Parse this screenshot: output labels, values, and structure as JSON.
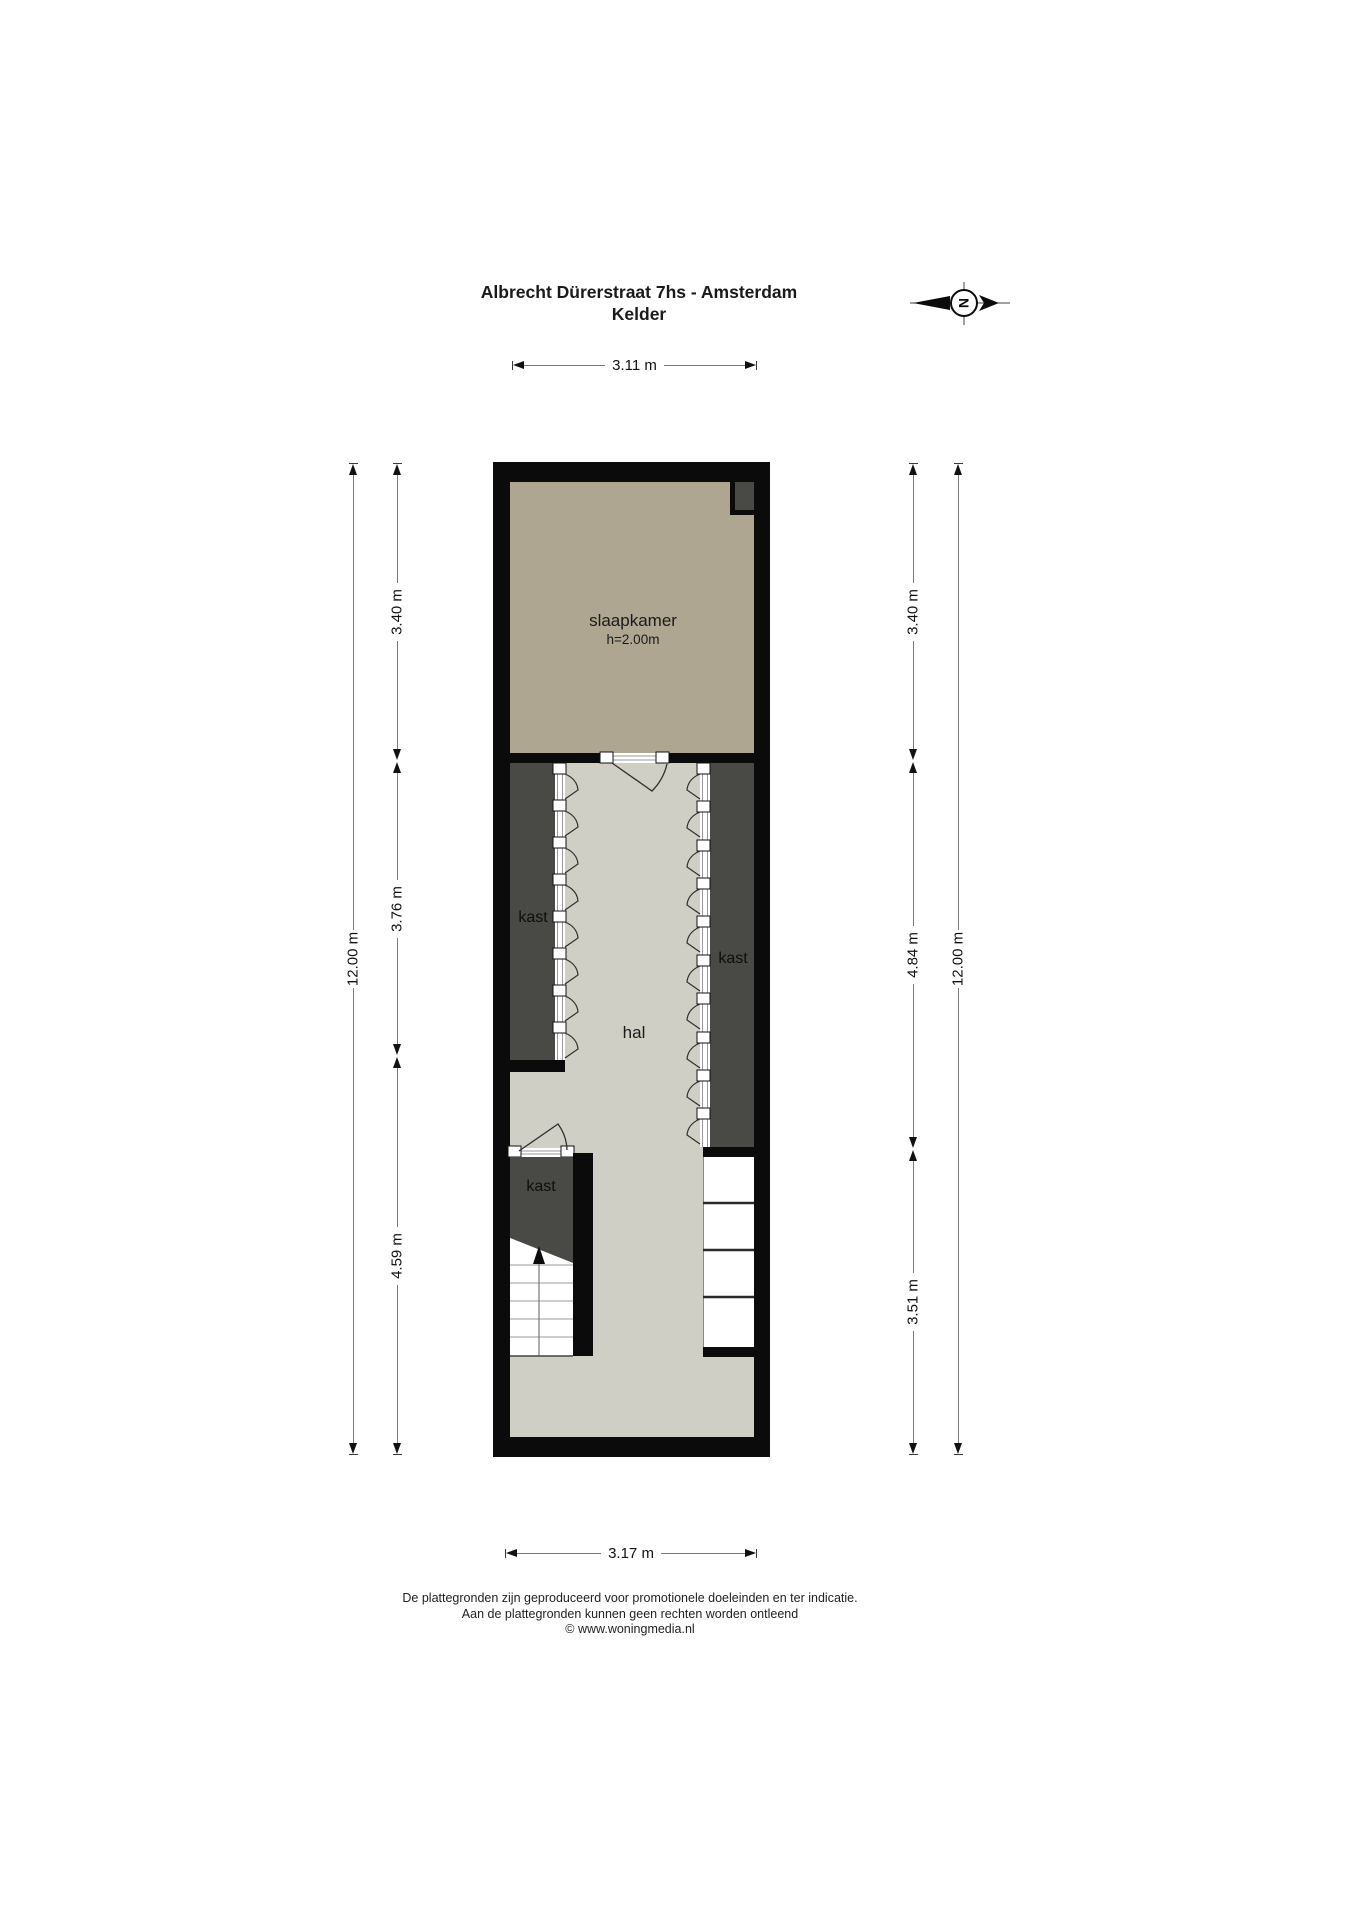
{
  "title": {
    "line1": "Albrecht Dürerstraat 7hs - Amsterdam",
    "line2": "Kelder"
  },
  "compass": {
    "north_label": "N"
  },
  "dims": {
    "top": "3.11 m",
    "bottom": "3.17 m",
    "left": [
      "3.40 m",
      "3.76 m",
      "4.59 m"
    ],
    "left_total": "12.00 m",
    "right": [
      "3.40 m",
      "4.84 m",
      "3.51 m"
    ],
    "right_total": "12.00 m"
  },
  "rooms": {
    "slaapkamer": {
      "name": "slaapkamer",
      "height_note": "h=2.00m"
    },
    "hal": {
      "name": "hal"
    },
    "kast_left": {
      "name": "kast"
    },
    "kast_right": {
      "name": "kast"
    },
    "kast_lower": {
      "name": "kast"
    }
  },
  "footer": {
    "line1": "De plattegronden zijn geproduceerd voor promotionele doeleinden en ter indicatie.",
    "line2": "Aan de plattegronden kunnen geen rechten worden ontleend",
    "line3": "© www.woningmedia.nl"
  },
  "colors": {
    "wall": "#0b0b0b",
    "slaapkamer_floor": "#afa692",
    "kast_floor": "#494946",
    "hal_floor": "#d0cfc6",
    "dimension_line": "#7a7a7a"
  }
}
